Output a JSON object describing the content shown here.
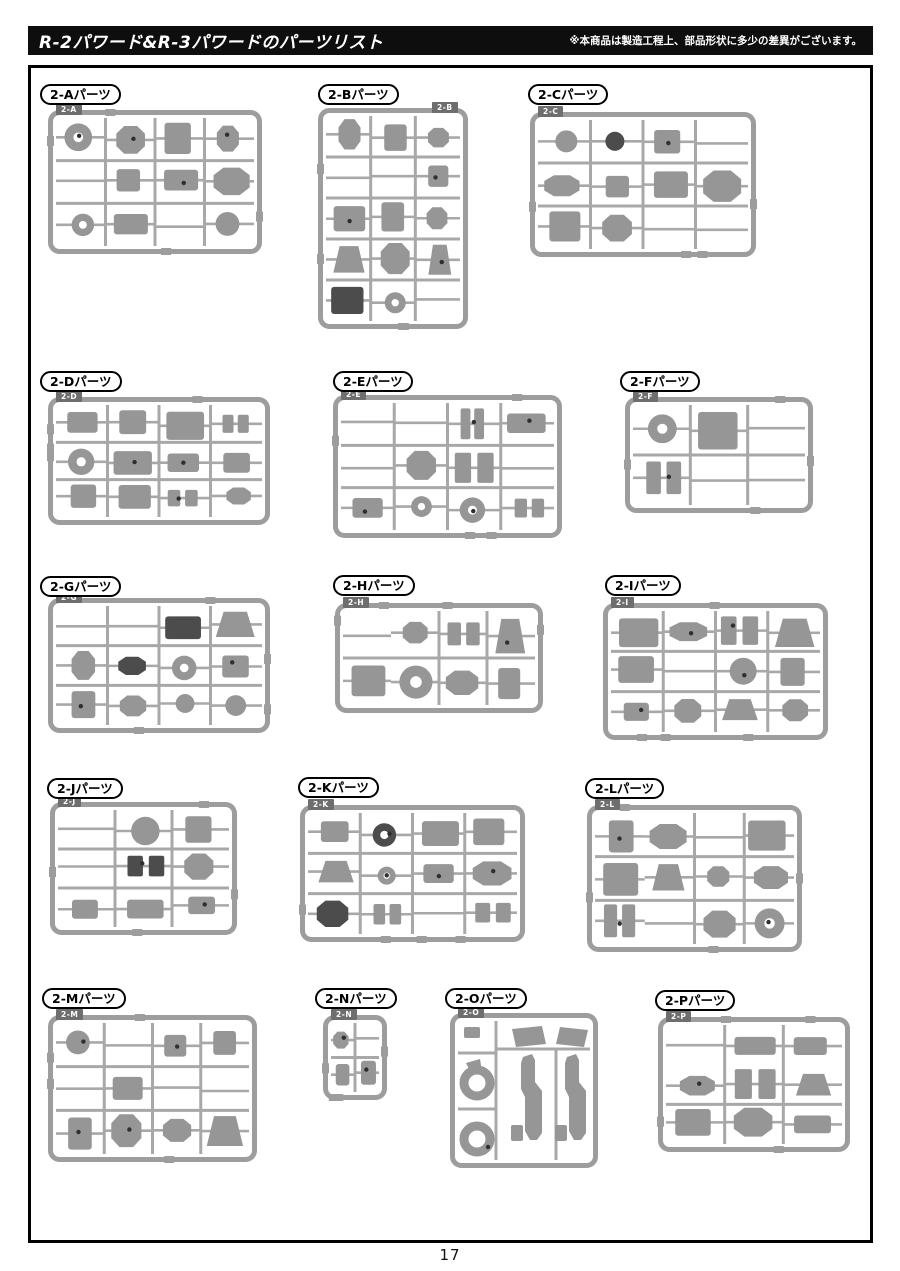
{
  "header": {
    "title": "R-2パワード&R-3パワードのパーツリスト",
    "note": "※本商品は製造工程上、部品形状に多少の差異がございます。"
  },
  "page_number": "17",
  "sections": [
    {
      "id": "2-A",
      "label": "2-Aパーツ",
      "tag": "2-A"
    },
    {
      "id": "2-B",
      "label": "2-Bパーツ",
      "tag": "2-B"
    },
    {
      "id": "2-C",
      "label": "2-Cパーツ",
      "tag": "2-C"
    },
    {
      "id": "2-D",
      "label": "2-Dパーツ",
      "tag": "2-D"
    },
    {
      "id": "2-E",
      "label": "2-Eパーツ",
      "tag": "2-E"
    },
    {
      "id": "2-F",
      "label": "2-Fパーツ",
      "tag": "2-F"
    },
    {
      "id": "2-G",
      "label": "2-Gパーツ",
      "tag": "2-G"
    },
    {
      "id": "2-H",
      "label": "2-Hパーツ",
      "tag": "2-H"
    },
    {
      "id": "2-I",
      "label": "2-Iパーツ",
      "tag": "2-I"
    },
    {
      "id": "2-J",
      "label": "2-Jパーツ",
      "tag": "2-J"
    },
    {
      "id": "2-K",
      "label": "2-Kパーツ",
      "tag": "2-K"
    },
    {
      "id": "2-L",
      "label": "2-Lパーツ",
      "tag": "2-L"
    },
    {
      "id": "2-M",
      "label": "2-Mパーツ",
      "tag": "2-M"
    },
    {
      "id": "2-N",
      "label": "2-Nパーツ",
      "tag": "2-N"
    },
    {
      "id": "2-O",
      "label": "2-Oパーツ",
      "tag": "2-O"
    },
    {
      "id": "2-P",
      "label": "2-Pパーツ",
      "tag": "2-P"
    }
  ],
  "colors": {
    "header_bg": "#0e0e0e",
    "runner_frame": "#9d9d9d",
    "runner_line": "#a8a8a8",
    "part_fill": "#969696",
    "part_dark": "#4c4c4c",
    "tag_bg": "#6e6e6e",
    "dot": "#2f2f2f"
  }
}
